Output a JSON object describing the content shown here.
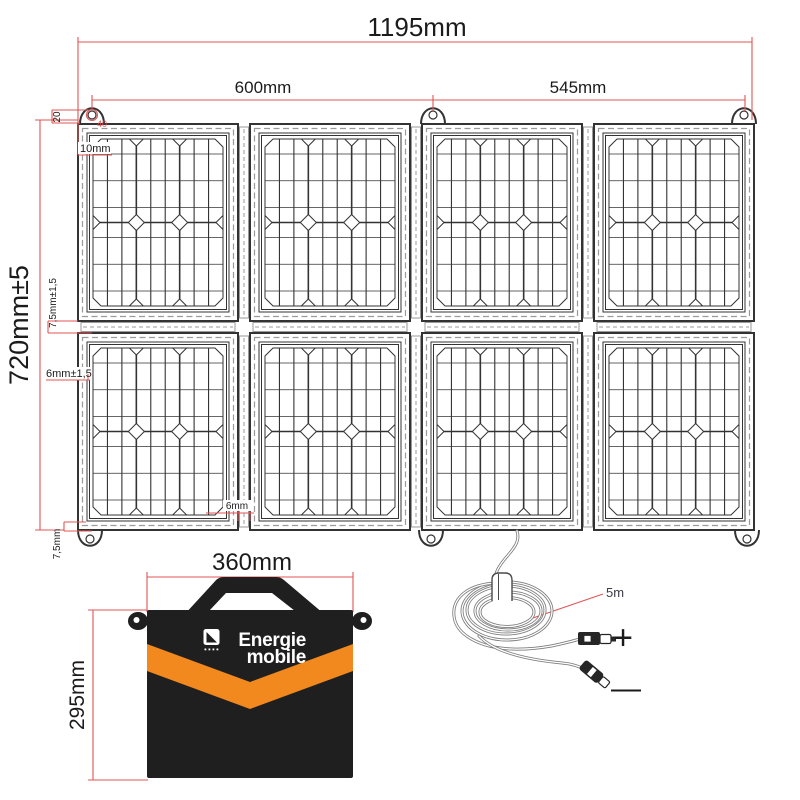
{
  "dims": {
    "overall_width": "1195mm",
    "left_section": "600mm",
    "right_section": "545mm",
    "overall_height": "720mm±5",
    "loop_height": "20",
    "loop_hole": "40",
    "top_margin": "10mm",
    "row_gap": "7,5mm±1,5",
    "stitch_margin": "6mm±1,5",
    "bottom_margin": "7,5mm",
    "panel_gap": "6mm"
  },
  "cable": {
    "length_label": "5m",
    "positive_symbol": "+",
    "negative_symbol": "—"
  },
  "bag": {
    "width": "360mm",
    "height": "295mm",
    "brand_top": "Energie",
    "brand_bottom": "mobile"
  },
  "panel_layout": {
    "columns": 4,
    "rows": 2,
    "cells_per_panel_columns": 3,
    "cells_per_panel_rows": 2,
    "mount_loops_top": 3,
    "mount_loops_bottom": 3
  },
  "colors": {
    "dimension_red": "#e05555",
    "ink": "#333333",
    "stitch_gray": "#9a9a9a",
    "bag_black": "#1f1f1f",
    "stripe_orange": "#f2891f",
    "logo_white": "#ffffff",
    "cable_gray": "#7d7d7d",
    "label_dark": "#3c3c48"
  }
}
